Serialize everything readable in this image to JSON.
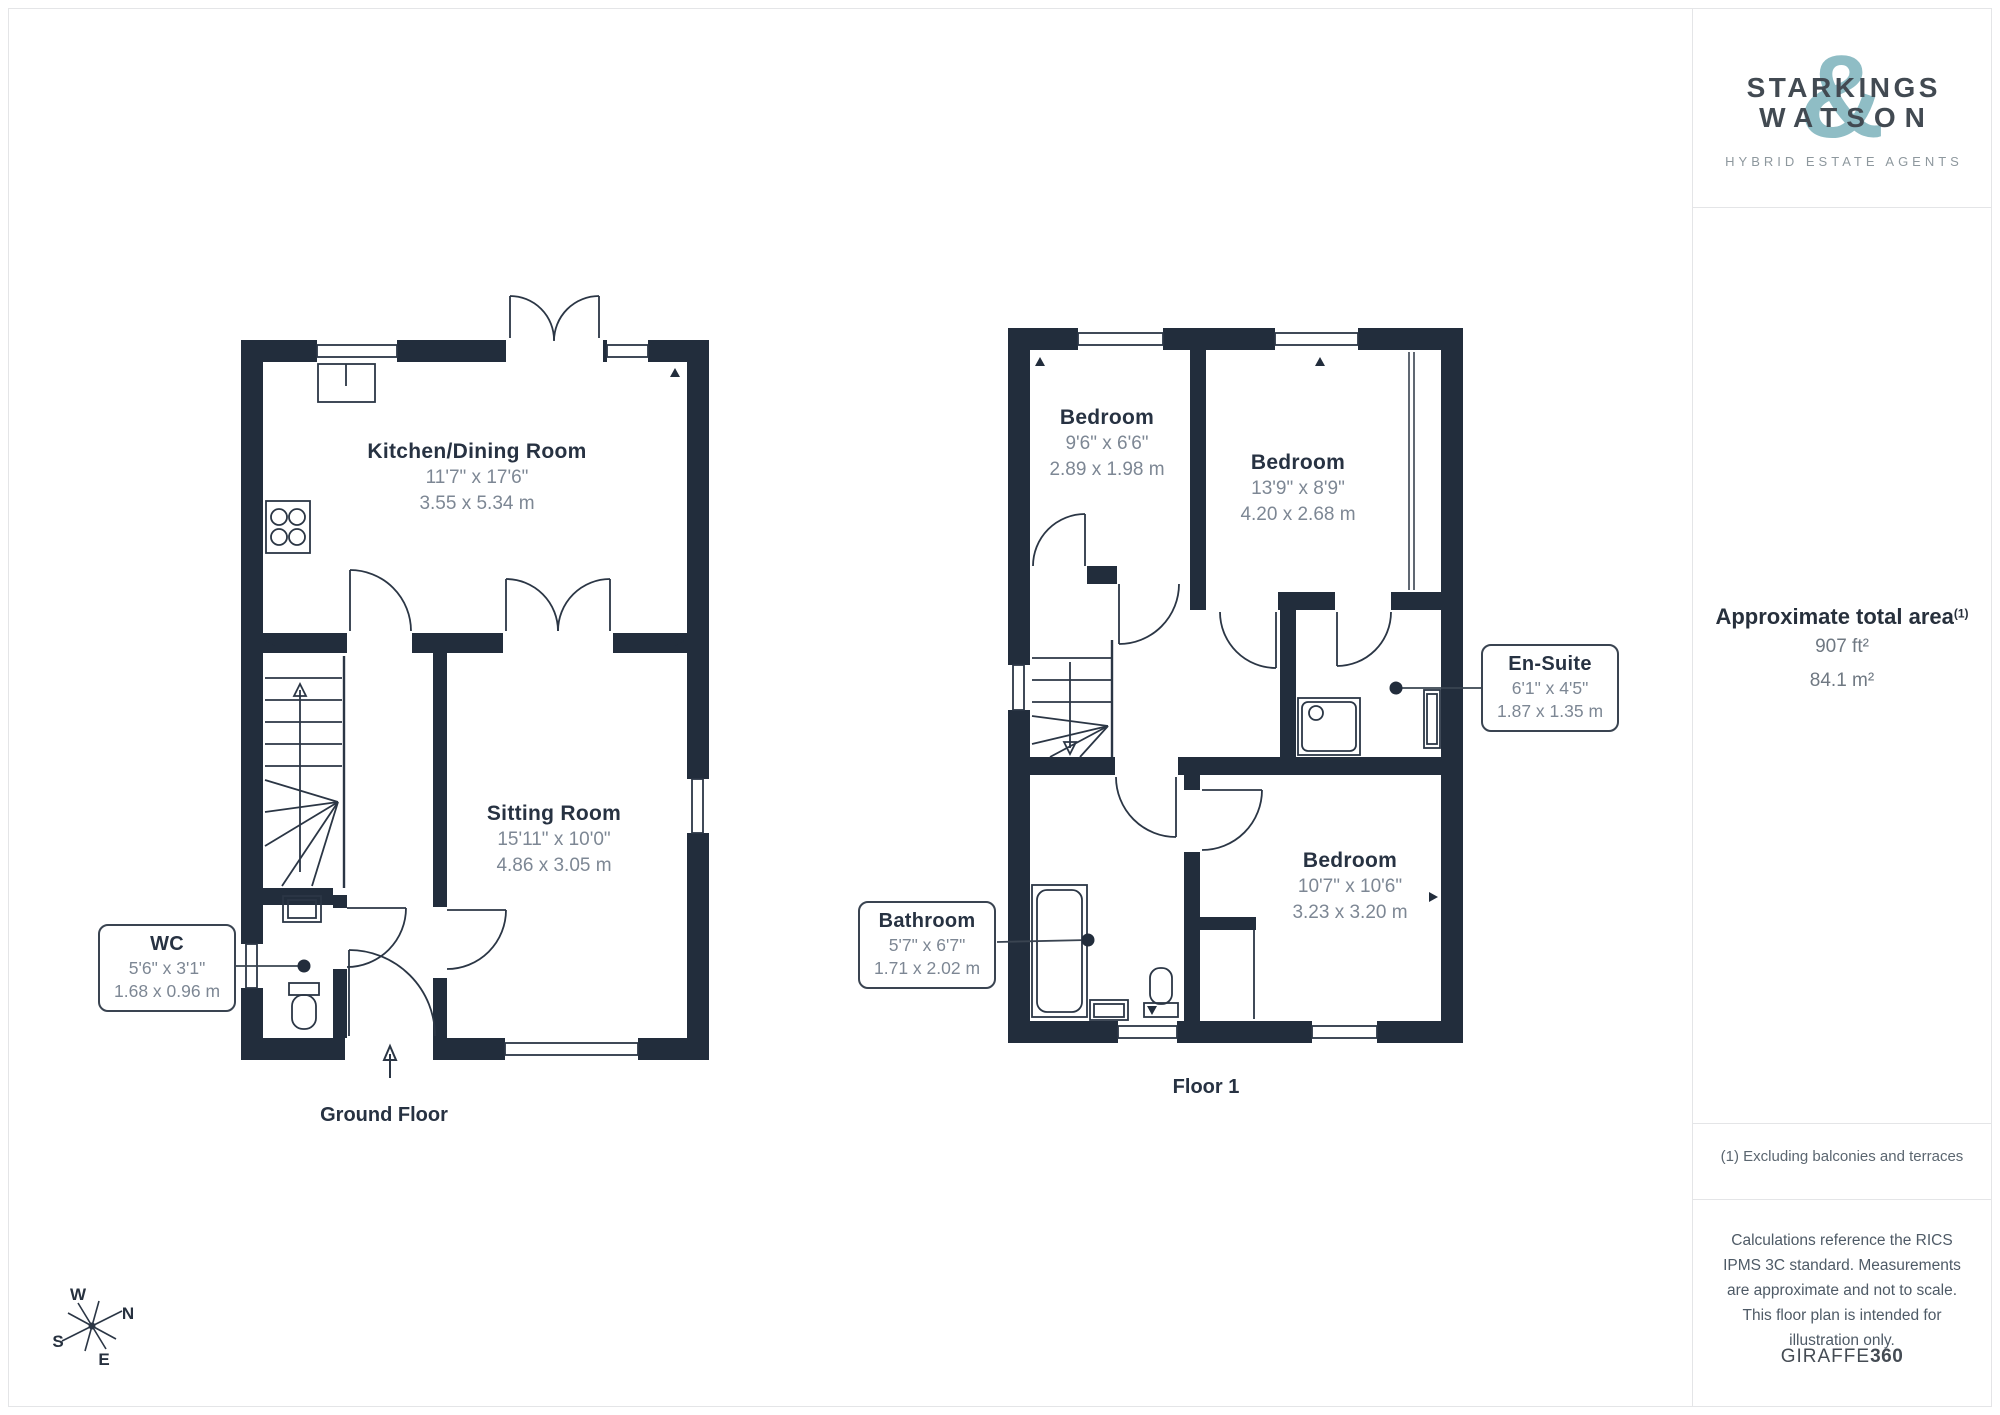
{
  "branding": {
    "line1": "STARKINGS",
    "line2": "WATSON",
    "ampersand": "&",
    "tagline": "HYBRID ESTATE AGENTS"
  },
  "sidebar": {
    "area_title": "Approximate total area",
    "area_footnote_marker": "(1)",
    "area_imperial": "907 ft²",
    "area_metric": "84.1 m²",
    "footnote": "(1) Excluding balconies and terraces",
    "disclaimer": "Calculations reference the RICS IPMS 3C standard. Measurements are approximate and not to scale. This floor plan is intended for illustration only.",
    "provider_name": "GIRAFFE",
    "provider_suffix": "360"
  },
  "floors": {
    "ground": {
      "label": "Ground Floor",
      "rooms": {
        "kitchen": {
          "name": "Kitchen/Dining Room",
          "imperial": "11'7\" x 17'6\"",
          "metric": "3.55 x 5.34 m"
        },
        "sitting": {
          "name": "Sitting Room",
          "imperial": "15'11\" x 10'0\"",
          "metric": "4.86 x 3.05 m"
        },
        "wc": {
          "name": "WC",
          "imperial": "5'6\" x 3'1\"",
          "metric": "1.68 x 0.96 m"
        }
      }
    },
    "first": {
      "label": "Floor 1",
      "rooms": {
        "bedroom1": {
          "name": "Bedroom",
          "imperial": "9'6\" x 6'6\"",
          "metric": "2.89 x 1.98 m"
        },
        "bedroom2": {
          "name": "Bedroom",
          "imperial": "13'9\" x 8'9\"",
          "metric": "4.20 x 2.68 m"
        },
        "bedroom3": {
          "name": "Bedroom",
          "imperial": "10'7\" x 10'6\"",
          "metric": "3.23 x 3.20 m"
        },
        "ensuite": {
          "name": "En-Suite",
          "imperial": "6'1\" x 4'5\"",
          "metric": "1.87 x 1.35 m"
        },
        "bathroom": {
          "name": "Bathroom",
          "imperial": "5'7\" x 6'7\"",
          "metric": "1.71 x 2.02 m"
        }
      }
    }
  },
  "compass": {
    "n": "N",
    "e": "E",
    "s": "S",
    "w": "W"
  },
  "colors": {
    "wall": "#222d3c",
    "accent": "#8fbdc5",
    "dim_text": "#7d8794"
  }
}
